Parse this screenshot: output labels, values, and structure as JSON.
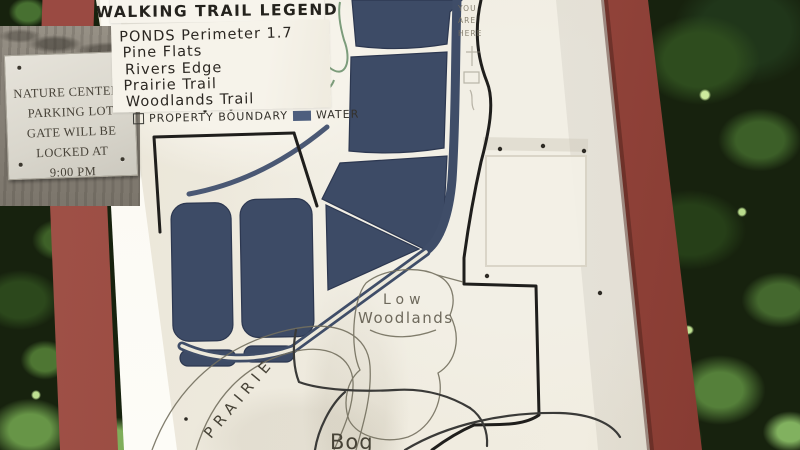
{
  "signboard": {
    "plaque": {
      "lines": [
        "NATURE CENTERS",
        "PARKING LOT",
        "GATE WILL BE",
        "LOCKED AT",
        "9:00 PM"
      ]
    },
    "legend": {
      "title": "WALKING TRAIL LEGEND",
      "trails": [
        "PONDS Perimeter 1.7",
        "Pine Flats",
        "Rivers Edge",
        "Prairie Trail",
        "Woodlands Trail"
      ],
      "boundary_label": "PROPERTY BOUNDARY",
      "water_label": "WATER",
      "water_color": "#4d5e7e"
    },
    "map_labels": {
      "you_are_here": "YOU ARE HERE",
      "low": "Low",
      "woodlands": "Woodlands",
      "prairie": "PRAIRIE",
      "bog": "Bog"
    },
    "colors": {
      "pond": "#3d4b66",
      "frame_red": "#9a4a42",
      "boundary_line": "#1f1e1c",
      "board": "#efebdf"
    }
  }
}
